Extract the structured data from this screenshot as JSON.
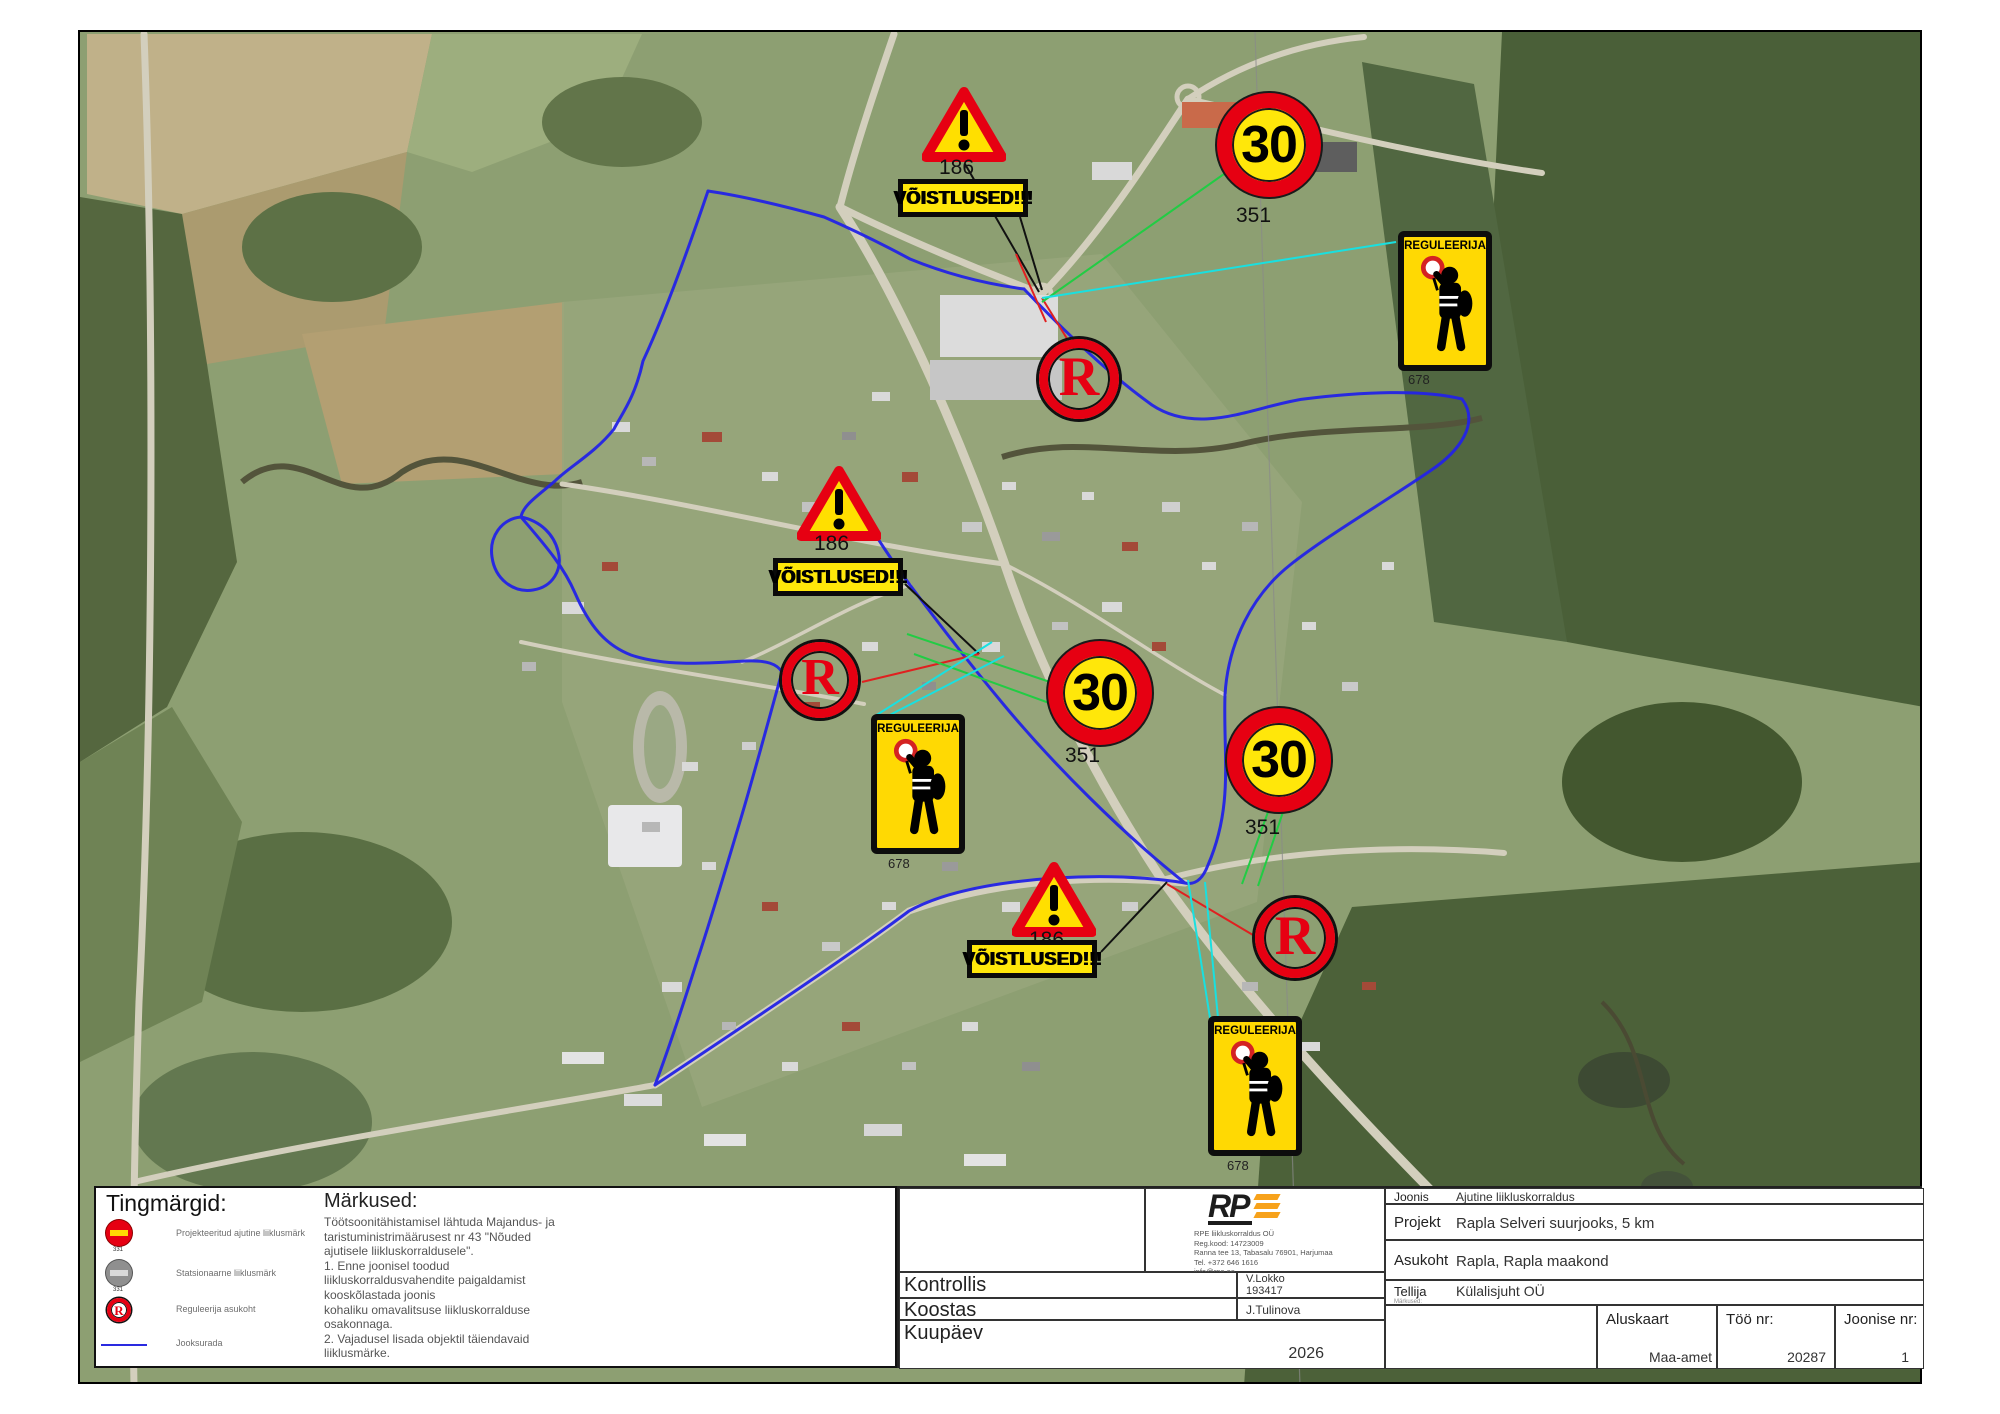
{
  "map": {
    "signs": {
      "voistlused": "VÕISTLUSED!!!",
      "reguleerija": "REGULEERIJA",
      "speed": "30",
      "r_letter": "R",
      "warning_code": "186",
      "speed_code": "351",
      "reguleerija_code": "678"
    }
  },
  "legend": {
    "title": "Tingmärgid:",
    "items": [
      {
        "icon": "temporary-no-entry-sign",
        "code": "331",
        "label": "Projekteeritud ajutine liiklusmärk"
      },
      {
        "icon": "stationary-sign",
        "code": "331",
        "label": "Statsionaarne liiklusmärk"
      },
      {
        "icon": "reguleerija-r-sign",
        "code": "",
        "label": "Reguleerija asukoht"
      },
      {
        "icon": "blue-route-line",
        "code": "",
        "label": "Jooksurada"
      }
    ]
  },
  "notes": {
    "title": "Märkused:",
    "body": "Töötsoonitähistamisel lähtuda Majandus- ja\ntaristuministrimäärusest nr 43 \"Nõuded\najutisele liikluskorraldusele\".\n1. Enne joonisel toodud\nliikluskorraldusvahendite paigaldamist\nkooskõlastada joonis\nkohaliku omavalitsuse liikluskorralduse\nosakonnaga.\n2. Vajadusel lisada objektil täiendavaid\nliiklusmärke."
  },
  "company": {
    "logo_rp": "RP",
    "info": "RPE liikluskorraldus OÜ\nReg.kood: 14723009\nRanna tee 13, Tabasalu 76901, Harjumaa\nTel. +372 646 1616\ninfo@rpe.ee"
  },
  "title_block": {
    "kontrollis_label": "Kontrollis",
    "kontrollis_value": "V.Lokko\n193417",
    "koostas_label": "Koostas",
    "koostas_value": "J.Tulinova",
    "kuupaev_label": "Kuupäev",
    "kuupaev_value": "2026",
    "joonis_label": "Joonis",
    "joonis_value": "Ajutine liikluskorraldus",
    "projekt_label": "Projekt",
    "projekt_value": "Rapla Selveri suurjooks, 5 km",
    "asukoht_label": "Asukoht",
    "asukoht_value": "Rapla, Rapla maakond",
    "tellija_label": "Tellija",
    "tellija_sub": "Märkused:",
    "tellija_value": "Külalisjuht OÜ",
    "aluskaart_label": "Aluskaart",
    "aluskaart_value": "Maa-amet",
    "too_nr_label": "Töö nr:",
    "too_nr_value": "20287",
    "joonise_nr_label": "Joonise nr:",
    "joonise_nr_value": "1"
  }
}
